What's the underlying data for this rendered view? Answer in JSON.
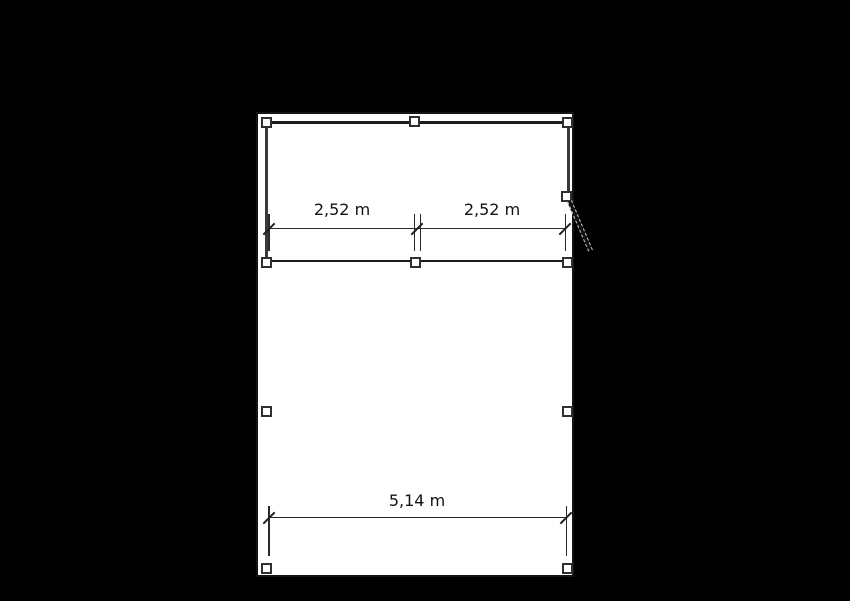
{
  "colors": {
    "background": "#000000",
    "paper": "#ffffff",
    "line": "#1b1b1b",
    "wall": "#3a3a3a",
    "handle_fill": "#ffffff",
    "handle_border": "#2f2f2f",
    "door_dash": "#c8c8c8",
    "text": "#111111"
  },
  "dimensions": {
    "upper": {
      "left_label": "2,52 m",
      "right_label": "2,52 m"
    },
    "bottom": {
      "label": "5,14 m"
    }
  }
}
